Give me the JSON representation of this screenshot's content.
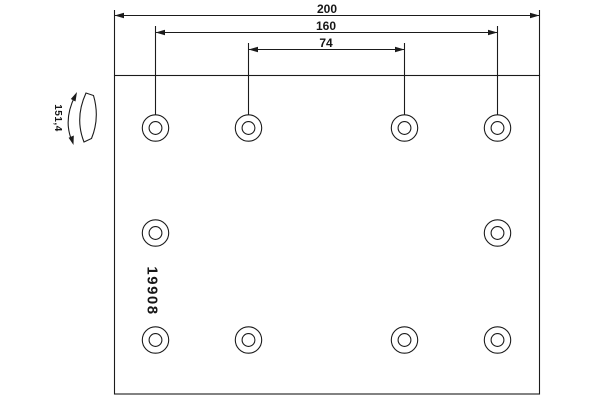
{
  "drawing": {
    "dimensions": {
      "total_length": "200",
      "outer_hole_spacing": "160",
      "inner_hole_spacing": "74"
    },
    "radius": "151,4",
    "part_number": "19908",
    "holes": {
      "count": 10,
      "rows_top_to_bottom": [
        4,
        2,
        4
      ]
    },
    "colors": {
      "line": "#1b1b1b",
      "background": "#ffffff"
    },
    "icons": {
      "curvature_arrow": "curved-arc-double-arrow",
      "lining_profile": "curved-band"
    }
  }
}
